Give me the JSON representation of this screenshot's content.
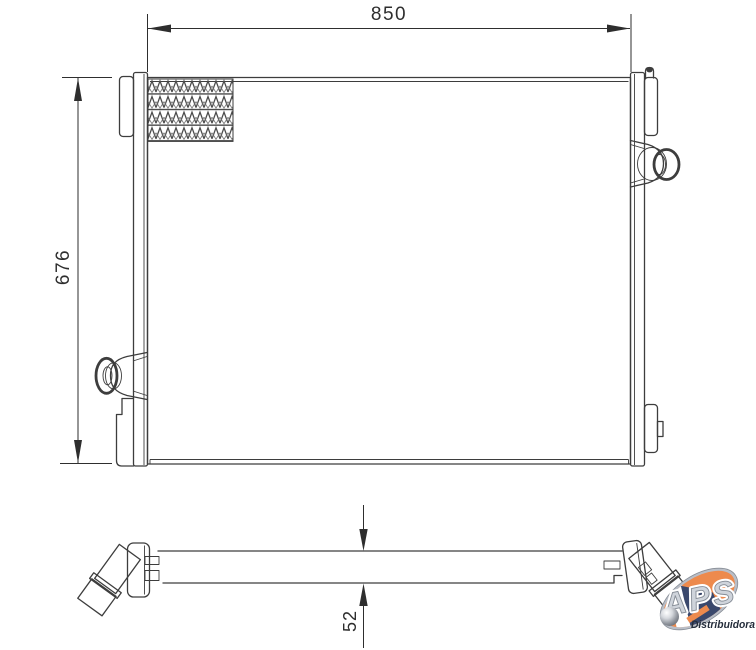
{
  "colors": {
    "background": "#ffffff",
    "line": "#3d3d3d",
    "dim_text": "#2e2e2e",
    "logo_orange": "#ED8A4D",
    "logo_navy": "#3A486C",
    "logo_silver": "#b9bec7"
  },
  "dimensions": {
    "overall_width": "850",
    "overall_height": "676",
    "core_thickness": "52"
  },
  "logo": {
    "brand": "APS",
    "subtitle": "Distribuidora"
  }
}
